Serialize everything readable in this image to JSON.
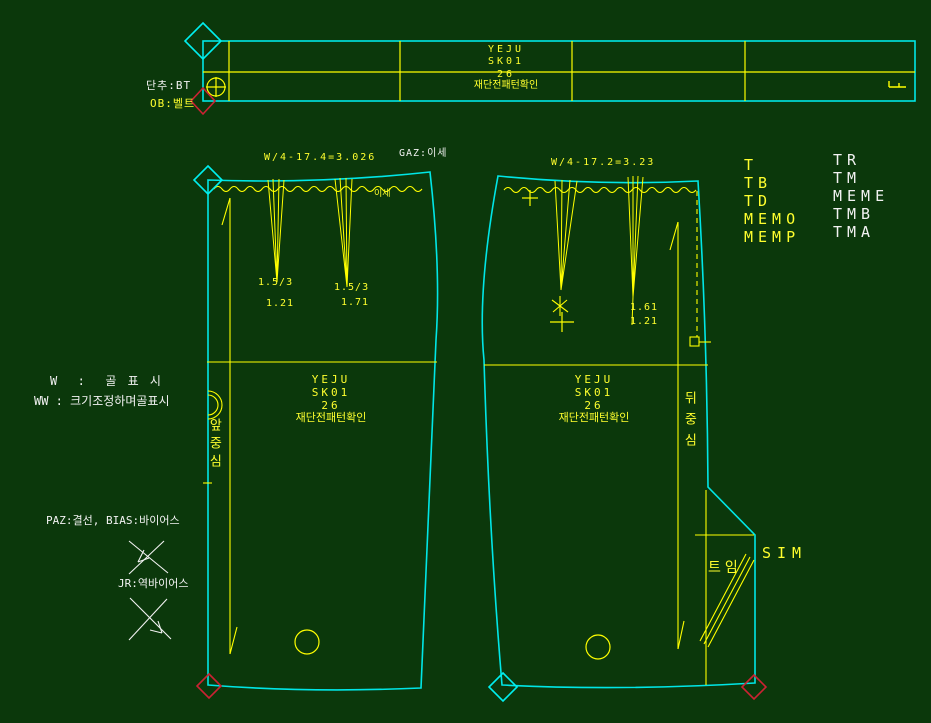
{
  "app": {
    "name": "pattern-cad-canvas"
  },
  "colors": {
    "background": "#0b380b",
    "outline_cyan": "#00e6e6",
    "line_yellow": "#ffff00",
    "text_white": "#f2f2f2",
    "marker_red": "#cc2233"
  },
  "waistband": {
    "button_label": "단추:BT",
    "belt_label": "OB:벨트",
    "title_lines": [
      "YEJU",
      "SK01",
      "26",
      "재단전패턴확인"
    ]
  },
  "annotations": {
    "formula_left": "W/4-17.4=3.026",
    "gaz_label": "GAZ:이세",
    "formula_right": "W/4-17.2=3.23",
    "ease_label": "이세",
    "fold_legend_1": "W  :  골 표 시",
    "fold_legend_2": "WW : 크기조정하며골표시",
    "paz_legend": "PAZ:결선, BIAS:바이어스",
    "jr_legend": "JR:역바이어스",
    "vent_label": "트임",
    "sim_label": "SIM"
  },
  "front_piece": {
    "title_lines": [
      "YEJU",
      "SK01",
      "26",
      "재단전패턴확인"
    ],
    "center_label": "앞중심",
    "dart_labels": {
      "d1_top": "1.5/3",
      "d1_bottom": "1.21",
      "d2_top": "1.5/3",
      "d2_bottom": "1.71"
    }
  },
  "back_piece": {
    "title_lines": [
      "YEJU",
      "SK01",
      "26",
      "재단전패턴확인"
    ],
    "center_label": "뒤중심",
    "dart_labels": {
      "d2_top": "1.61",
      "d2_bottom": "1.21"
    }
  },
  "command_menu": {
    "yellow_items": [
      "T",
      "TB",
      "TD",
      "MEMO",
      "MEMP"
    ],
    "white_items": [
      "TR",
      "TM",
      "MEME",
      "TMB",
      "TMA"
    ]
  }
}
